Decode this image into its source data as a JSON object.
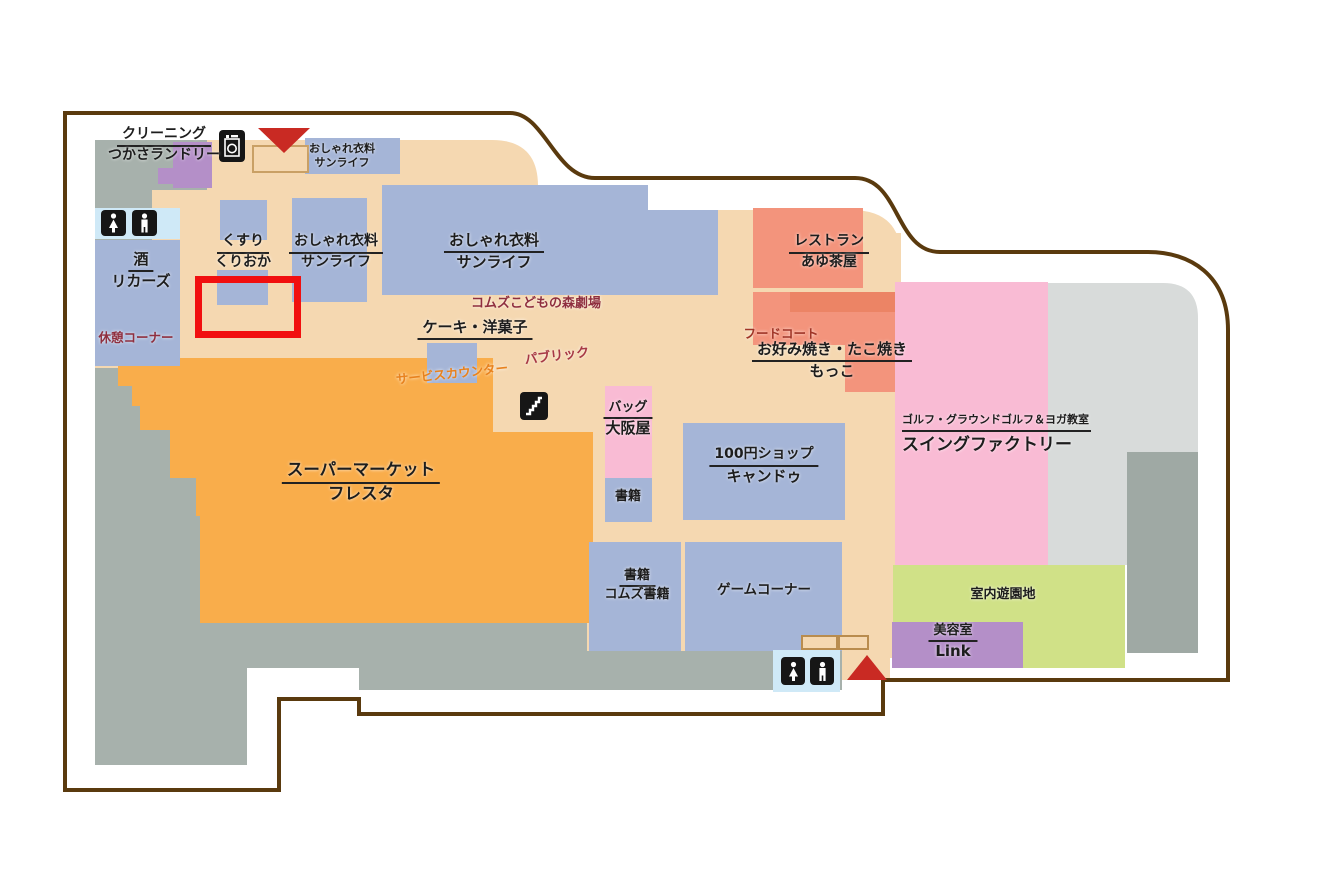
{
  "title": "ショッピングセンター フロアマップ",
  "stores": {
    "cleaning": {
      "category": "クリーニング",
      "name": "つかさランドリー"
    },
    "sunlife_entrance": {
      "category": "おしゃれ衣料",
      "name": "サンライフ"
    },
    "liquor": {
      "category": "酒",
      "name": "リカーズ"
    },
    "drug": {
      "category": "くすり",
      "name": "くりおか"
    },
    "sunlife_west": {
      "category": "おしゃれ衣料",
      "name": "サンライフ"
    },
    "sunlife_main": {
      "category": "おしゃれ衣料",
      "name": "サンライフ"
    },
    "restaurant": {
      "category": "レストラン",
      "name": "あゆ茶屋"
    },
    "cake": {
      "label": "ケーキ・洋菓子"
    },
    "supermarket": {
      "category": "スーパーマーケット",
      "name": "フレスタ"
    },
    "okonomiyaki": {
      "category": "お好み焼き・たこ焼き",
      "name": "もっこ"
    },
    "bag": {
      "category": "バッグ",
      "name": "大阪屋"
    },
    "books_small": {
      "label": "書籍"
    },
    "hundred_yen": {
      "category": "100円ショップ",
      "name": "キャンドゥ"
    },
    "golf": {
      "category": "ゴルフ・グラウンドゴルフ＆ヨガ教室",
      "name": "スイングファクトリー"
    },
    "books_comz": {
      "category": "書籍",
      "name": "コムズ書籍"
    },
    "game_corner": {
      "label": "ゲームコーナー"
    },
    "playground": {
      "label": "室内遊園地"
    },
    "beauty": {
      "category": "美容室",
      "name": "Link"
    }
  },
  "annotations": {
    "theater": "コムズこどもの森劇場",
    "rest_corner": "休憩コーナー",
    "service_counter": "サービスカウンター",
    "public": "パブリック",
    "food_court": "フードコート"
  },
  "facilities": {
    "restroom_top": {
      "icons": [
        "female-restroom-icon",
        "male-restroom-icon"
      ]
    },
    "restroom_bottom": {
      "icons": [
        "female-restroom-icon",
        "male-restroom-icon"
      ]
    },
    "laundry_icon": "washing-machine-icon",
    "stairs_icon": "stairs-icon"
  },
  "entrances": {
    "top": "entrance-arrow-down",
    "bottom": "entrance-arrow-up"
  },
  "highlight": {
    "shape": "rectangle",
    "color": "#f10f0f",
    "location": "くすり くりおか 前"
  },
  "colors": {
    "floor": "#f5d8b1",
    "room_blue": "#a5b5d7",
    "supermarket_orange": "#f9ad4b",
    "restaurant_salmon": "#f3947c",
    "food_court_salmon": "#ec8465",
    "pink": "#f9bbd4",
    "green": "#d0e187",
    "purple": "#b48fc8",
    "gray": "#a7b1ac",
    "light_gray": "#d8dbda",
    "mid_gray": "#9fa9a4",
    "toilet_blue": "#cfe9f7",
    "outline_brown": "#5a3a0e",
    "highlight_red": "#f10f0f",
    "arrow_red": "#c92a23",
    "text_maroon": "#8f2f3f",
    "text_orange": "#e8821e"
  }
}
